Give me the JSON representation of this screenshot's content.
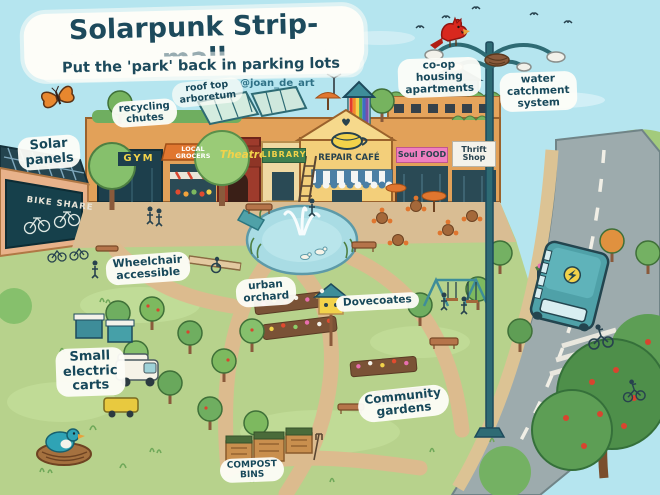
{
  "title": "Solarpunk Strip-mall",
  "subtitle": "Put the 'park' back in parking lots",
  "credit": "@joan_de_art",
  "annotations": [
    {
      "id": "solar-panels",
      "text": "Solar\npanels"
    },
    {
      "id": "recycling-chutes",
      "text": "recycling\nchutes"
    },
    {
      "id": "rooftop-arboretum",
      "text": "roof top\narboretum"
    },
    {
      "id": "coop-housing-apartments",
      "text": "co-op\nhousing\napartments"
    },
    {
      "id": "water-catchment-system",
      "text": "water\ncatchment\nsystem"
    },
    {
      "id": "wheelchair-accessible",
      "text": "Wheelchair\naccessible"
    },
    {
      "id": "urban-orchard",
      "text": "urban\norchard"
    },
    {
      "id": "dovecoates",
      "text": "Dovecoates"
    },
    {
      "id": "small-electric-carts",
      "text": "Small\nelectric\ncarts"
    },
    {
      "id": "community-gardens",
      "text": "Community\ngardens"
    },
    {
      "id": "compost-bins",
      "text": "COMPOST\nBINS"
    }
  ],
  "storefronts": [
    {
      "id": "gym",
      "label": "GYM"
    },
    {
      "id": "local-grocers",
      "label": "LOCAL\nGROCERS"
    },
    {
      "id": "theatre",
      "label": "Theatre"
    },
    {
      "id": "library",
      "label": "LIBRARY"
    },
    {
      "id": "repair-cafe",
      "label": "REPAIR CAFÉ"
    },
    {
      "id": "soul-food",
      "label": "Soul FOOD"
    },
    {
      "id": "thrift-shop",
      "label": "Thrift\nShop"
    }
  ],
  "bike_share_sign": "BIKE SHARE",
  "scene_icons": [
    "monarch-butterfly",
    "cardinal-bird",
    "flying-birds",
    "street-lamp-water-catchment",
    "water-tower",
    "rooftop-greenhouse",
    "rainbow-stair-tower",
    "wind-turbine",
    "pond-fountain",
    "ducks",
    "electric-bus",
    "cyclist",
    "bluebird-nest",
    "dovecote",
    "compost-bins",
    "swing-set",
    "cafe-tables",
    "bus-stop-flowers"
  ],
  "colors": {
    "sky": "#b5e5ef",
    "ink": "#1d4a5c",
    "building": "#e2a159",
    "grass": "#b7d28c",
    "path": "#d9bd93",
    "pond": "#a9dce4",
    "road": "#9dabad",
    "bus": "#4fa1a8",
    "solar_panel": "#24444f",
    "accent_orange": "#e0762f",
    "sign_pink": "#ef7fc0",
    "sign_green": "#3f7f4f",
    "sign_yellow": "#f2d24a",
    "cardinal_red": "#d8281e"
  }
}
